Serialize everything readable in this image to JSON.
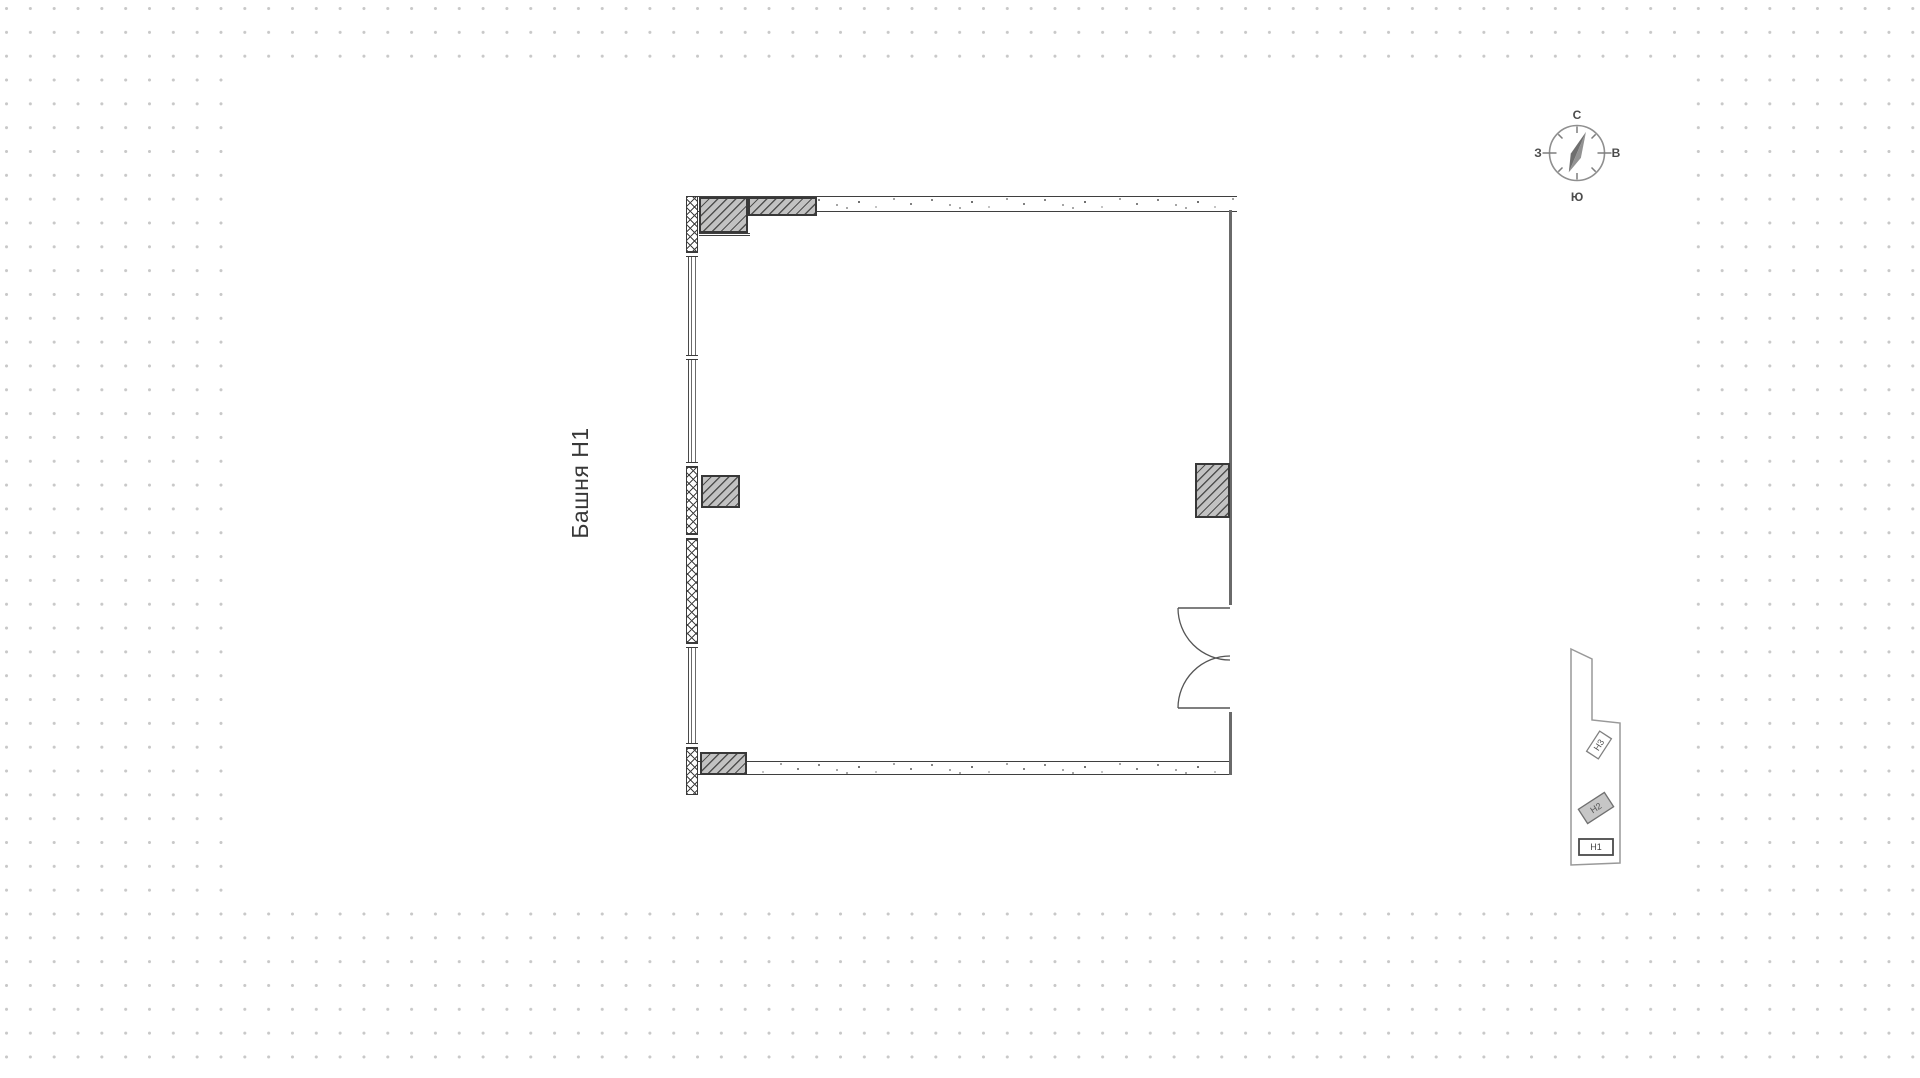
{
  "app": {
    "type": "floor-plan-viewer"
  },
  "title": {
    "text": "Башня Н1"
  },
  "compass": {
    "north": "С",
    "south": "Ю",
    "east": "В",
    "west": "З"
  },
  "minimap": {
    "buildings": [
      {
        "label": "Н3",
        "style": "outline"
      },
      {
        "label": "Н2",
        "style": "filled"
      },
      {
        "label": "Н1",
        "style": "selected"
      }
    ]
  },
  "colors": {
    "canvas": "#ffffff",
    "dot_grid": "#c8c8c8",
    "wall_line": "#3f3f3f",
    "column_fill": "#c2c2c2",
    "compass_stroke": "#8f8f8f"
  }
}
